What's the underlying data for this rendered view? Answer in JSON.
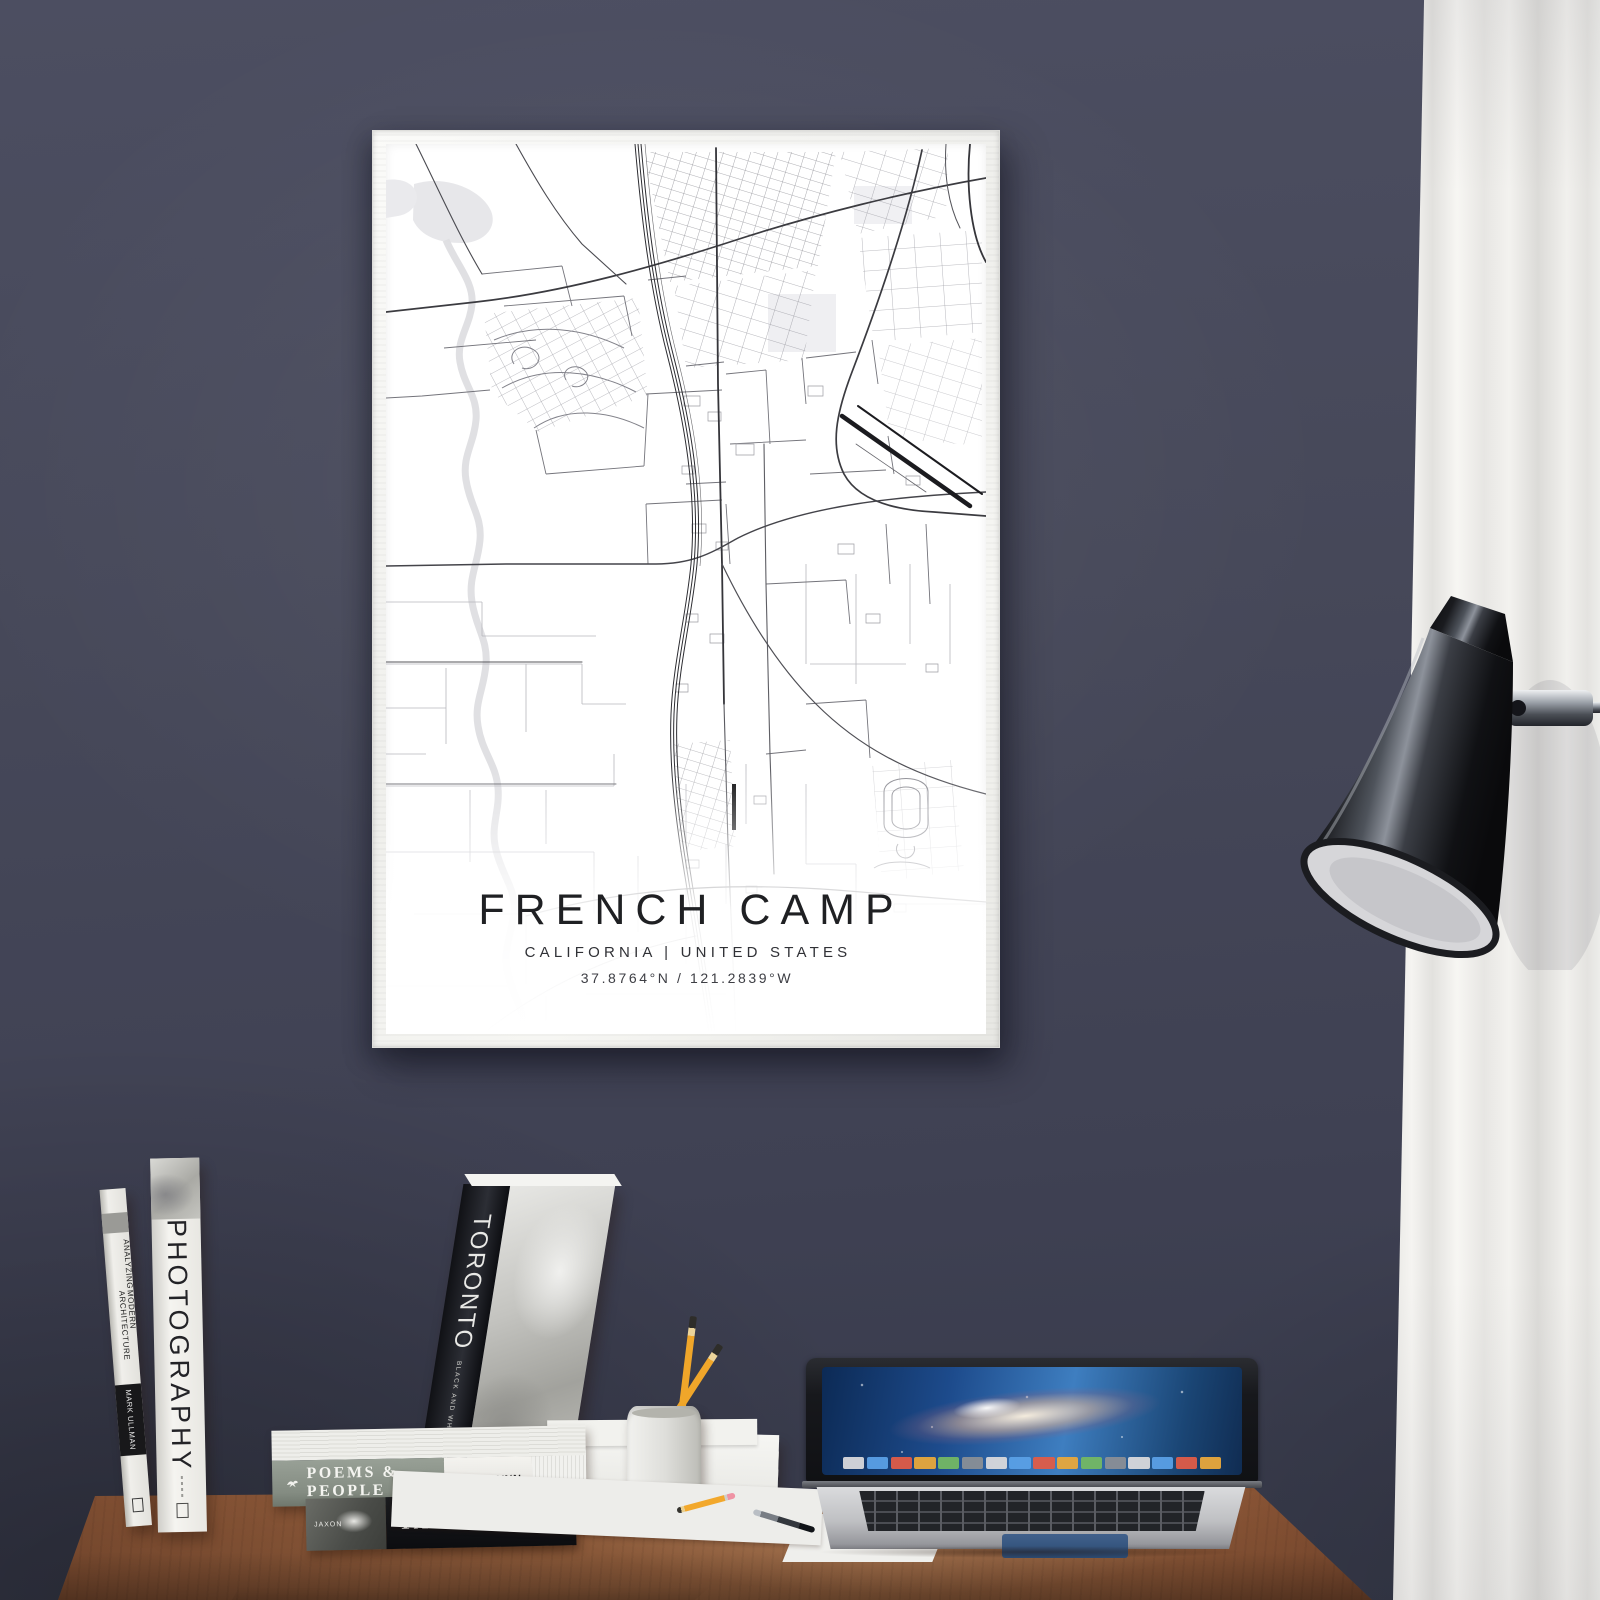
{
  "poster": {
    "title": "FRENCH CAMP",
    "subtitle": "CALIFORNIA | UNITED STATES",
    "coordinates": "37.8764°N / 121.2839°W",
    "location": "French Camp, California, United States"
  },
  "books": {
    "architecture": {
      "title_line1": "ANALYZING",
      "title_line2": "MODERN ARCHITECTURE",
      "author": "MARK ULLMAN"
    },
    "photography": {
      "title": "PHOTOGRAPHY"
    },
    "toronto": {
      "title": "TORONTO",
      "subtitle": "BLACK AND WHITE",
      "author": "STUART TYLER"
    },
    "poems": {
      "title": "POEMS & PEOPLE",
      "author": "BEN FLYNN"
    },
    "yacht": {
      "title": "YACHT",
      "subtitle": "A PHOTO JOURNAL",
      "left_label": "JAXON"
    }
  },
  "colors": {
    "wall": "#43465a",
    "desk_wood": "#8f5a3c",
    "curtain": "#f1f0ed",
    "poster_paper": "#ffffff",
    "map_ink": "#2c2c31",
    "frame": "#f2f2ee"
  }
}
